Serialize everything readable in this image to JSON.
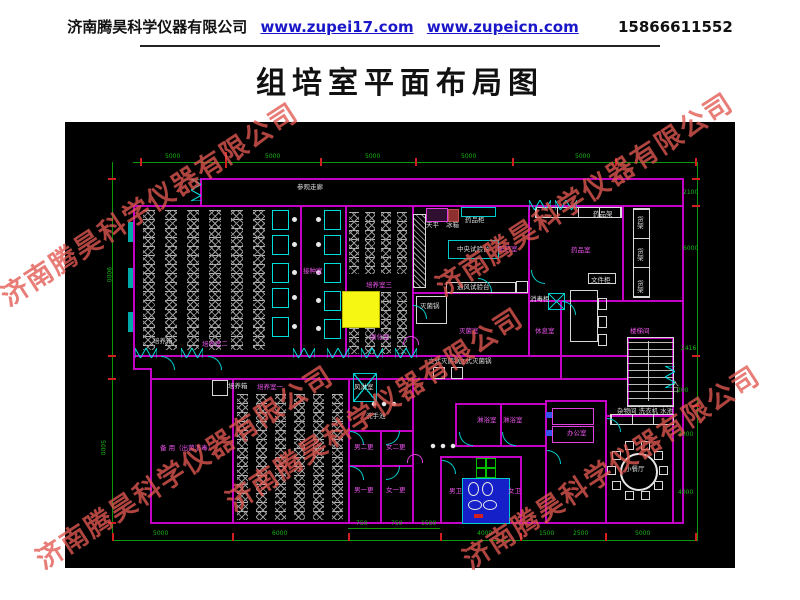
{
  "header": {
    "company": "济南腾昊科学仪器有限公司",
    "url1": "www.zupei17.com",
    "url2": "www.zupeicn.com",
    "phone": "15866611552"
  },
  "title": "组培室平面布局图",
  "watermark": {
    "text": "济南腾昊科学仪器有限公司",
    "positions": [
      [
        150,
        205
      ],
      [
        585,
        195
      ],
      [
        375,
        410
      ],
      [
        185,
        468
      ],
      [
        612,
        468
      ]
    ]
  },
  "colors": {
    "wall": "#c400c4",
    "dimension_line": "#0c9a0c",
    "room_label": "#ee55ee",
    "equipment_label": "#dddddd",
    "highlight_box": "#f7f714",
    "watermark": "#e25852",
    "link": "#1a17c9"
  },
  "plan": {
    "labels": [
      {
        "t": "参观走廊",
        "x": 232,
        "y": 62,
        "c": "w"
      },
      {
        "t": "培养箱",
        "x": 88,
        "y": 216,
        "c": "w"
      },
      {
        "t": "培养箱",
        "x": 163,
        "y": 261,
        "c": "w"
      },
      {
        "t": "天平",
        "x": 361,
        "y": 100,
        "c": "w"
      },
      {
        "t": "冰箱",
        "x": 381,
        "y": 100,
        "c": "w"
      },
      {
        "t": "药品柜",
        "x": 400,
        "y": 95,
        "c": "w"
      },
      {
        "t": "中央试验台",
        "x": 392,
        "y": 124,
        "c": "w"
      },
      {
        "t": "通风试验台",
        "x": 392,
        "y": 162,
        "c": "w"
      },
      {
        "t": "灭菌锅",
        "x": 355,
        "y": 181,
        "c": "w"
      },
      {
        "t": "药品架",
        "x": 528,
        "y": 89,
        "c": "w"
      },
      {
        "t": "货架",
        "x": 571,
        "y": 94,
        "c": "w",
        "v": 1
      },
      {
        "t": "货架",
        "x": 571,
        "y": 126,
        "c": "w",
        "v": 1
      },
      {
        "t": "货架",
        "x": 571,
        "y": 158,
        "c": "w",
        "v": 1
      },
      {
        "t": "消毒柜",
        "x": 465,
        "y": 174,
        "c": "w"
      },
      {
        "t": "立式灭菌锅",
        "x": 363,
        "y": 236,
        "c": "w"
      },
      {
        "t": "立式灭菌锅",
        "x": 394,
        "y": 236,
        "c": "w"
      },
      {
        "t": "风淋室",
        "x": 289,
        "y": 262,
        "c": "w"
      },
      {
        "t": "洗手池",
        "x": 301,
        "y": 291,
        "c": "w"
      },
      {
        "t": "小餐厅",
        "x": 560,
        "y": 344,
        "c": "w"
      },
      {
        "t": "杂物间 洗衣机 水池",
        "x": 552,
        "y": 286,
        "c": "w"
      },
      {
        "t": "文件柜",
        "x": 526,
        "y": 155,
        "c": "w"
      },
      {
        "t": "入口",
        "x": 606,
        "y": 258,
        "c": "w",
        "v": 1
      },
      {
        "t": "培养室二",
        "x": 137,
        "y": 219,
        "c": "m"
      },
      {
        "t": "接种室",
        "x": 238,
        "y": 146,
        "c": "m"
      },
      {
        "t": "培养室三",
        "x": 301,
        "y": 160,
        "c": "m"
      },
      {
        "t": "驯化室",
        "x": 305,
        "y": 212,
        "c": "m"
      },
      {
        "t": "培养室一",
        "x": 192,
        "y": 262,
        "c": "m"
      },
      {
        "t": "备 用（出菌消毒）",
        "x": 95,
        "y": 323,
        "c": "m"
      },
      {
        "t": "配药室",
        "x": 433,
        "y": 124,
        "c": "m"
      },
      {
        "t": "药品室",
        "x": 506,
        "y": 125,
        "c": "m"
      },
      {
        "t": "灭菌室",
        "x": 394,
        "y": 206,
        "c": "m"
      },
      {
        "t": "休息室",
        "x": 470,
        "y": 206,
        "c": "m"
      },
      {
        "t": "楼梯间",
        "x": 565,
        "y": 206,
        "c": "m"
      },
      {
        "t": "男二更",
        "x": 289,
        "y": 322,
        "c": "m"
      },
      {
        "t": "女二更",
        "x": 321,
        "y": 322,
        "c": "m"
      },
      {
        "t": "男一更",
        "x": 289,
        "y": 365,
        "c": "m"
      },
      {
        "t": "女一更",
        "x": 321,
        "y": 365,
        "c": "m"
      },
      {
        "t": "男卫",
        "x": 384,
        "y": 366,
        "c": "m"
      },
      {
        "t": "女卫",
        "x": 443,
        "y": 366,
        "c": "m"
      },
      {
        "t": "淋浴室",
        "x": 412,
        "y": 295,
        "c": "m"
      },
      {
        "t": "淋浴室",
        "x": 438,
        "y": 295,
        "c": "m"
      },
      {
        "t": "办公室",
        "x": 502,
        "y": 308,
        "c": "m"
      },
      {
        "t": "5000",
        "x": 100,
        "y": 32,
        "c": "g"
      },
      {
        "t": "5000",
        "x": 200,
        "y": 32,
        "c": "g"
      },
      {
        "t": "5000",
        "x": 300,
        "y": 32,
        "c": "g"
      },
      {
        "t": "5000",
        "x": 396,
        "y": 32,
        "c": "g"
      },
      {
        "t": "5000",
        "x": 510,
        "y": 32,
        "c": "g"
      },
      {
        "t": "9000",
        "x": 40,
        "y": 145,
        "c": "g",
        "v": 1
      },
      {
        "t": "5000",
        "x": 34,
        "y": 318,
        "c": "g",
        "v": 1
      },
      {
        "t": "2100",
        "x": 618,
        "y": 68,
        "c": "g"
      },
      {
        "t": "6000",
        "x": 618,
        "y": 124,
        "c": "g"
      },
      {
        "t": "2416",
        "x": 616,
        "y": 224,
        "c": "g"
      },
      {
        "t": "200",
        "x": 612,
        "y": 266,
        "c": "g"
      },
      {
        "t": "4000",
        "x": 613,
        "y": 310,
        "c": "g"
      },
      {
        "t": "4000",
        "x": 613,
        "y": 368,
        "c": "g"
      },
      {
        "t": "5000",
        "x": 88,
        "y": 409,
        "c": "g"
      },
      {
        "t": "6000",
        "x": 207,
        "y": 409,
        "c": "g"
      },
      {
        "t": "4000",
        "x": 412,
        "y": 409,
        "c": "g"
      },
      {
        "t": "1500",
        "x": 474,
        "y": 409,
        "c": "g"
      },
      {
        "t": "2500",
        "x": 508,
        "y": 409,
        "c": "g"
      },
      {
        "t": "5000",
        "x": 570,
        "y": 409,
        "c": "g"
      },
      {
        "t": "750",
        "x": 291,
        "y": 399,
        "c": "g"
      },
      {
        "t": "750",
        "x": 326,
        "y": 399,
        "c": "g"
      },
      {
        "t": "1500",
        "x": 356,
        "y": 399,
        "c": "g"
      }
    ]
  }
}
